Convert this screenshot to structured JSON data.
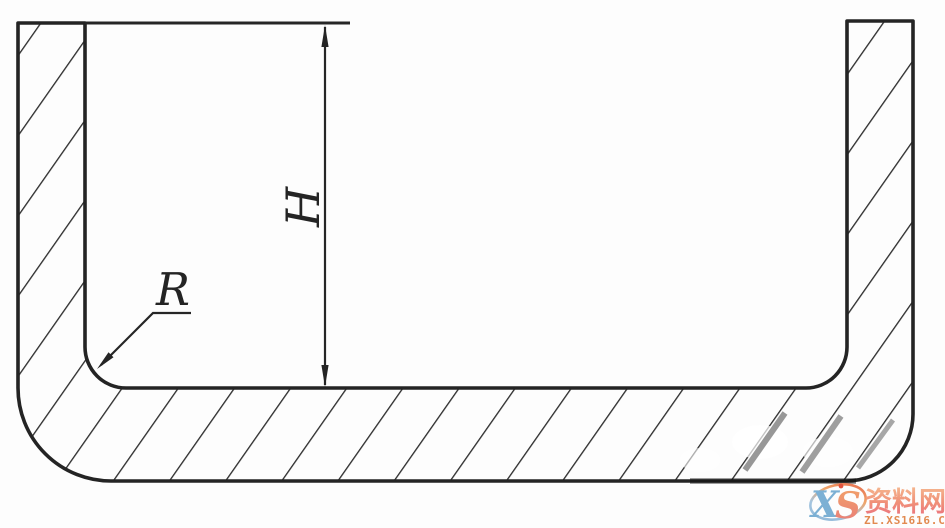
{
  "diagram": {
    "kind": "engineering cross-section of U-shaped drawn part",
    "height_label": "H",
    "radius_label": "R"
  },
  "watermark": {
    "logo_x": "X",
    "logo_s": "S",
    "site_name": "资料网",
    "site_url": "ZL.XS1616.COM",
    "remnant_text": "资料网"
  },
  "colors": {
    "line": "#242424",
    "hatch": "#2e2e2e",
    "background": "#fdfdfd",
    "wm_blue": "#7cb0d4",
    "wm_orange": "#e28a50",
    "wm_red_dot": "#e0523e"
  }
}
